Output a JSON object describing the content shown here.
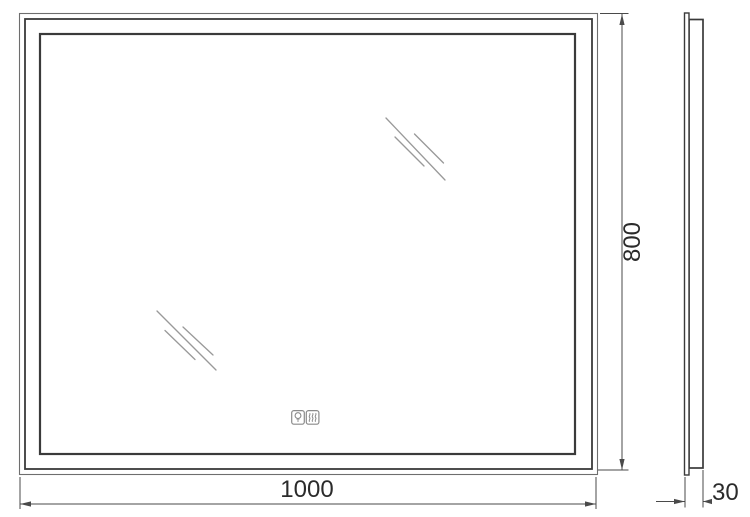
{
  "drawing": {
    "title": "mirror-technical-drawing",
    "views": {
      "front": "front-view",
      "side": "side-profile-view"
    }
  },
  "dimensions": {
    "width": "1000",
    "height": "800",
    "depth": "30"
  },
  "icons": {
    "light": "light-touch-button",
    "demister": "demister-touch-button"
  },
  "colors": {
    "frame_dark": "#3a3a3a",
    "frame_thin": "#6e6e6e",
    "hatch": "#999999",
    "dimension": "#4a4a4a",
    "icon": "#8a8a8a",
    "text": "#2b2b2b",
    "background": "#ffffff"
  }
}
